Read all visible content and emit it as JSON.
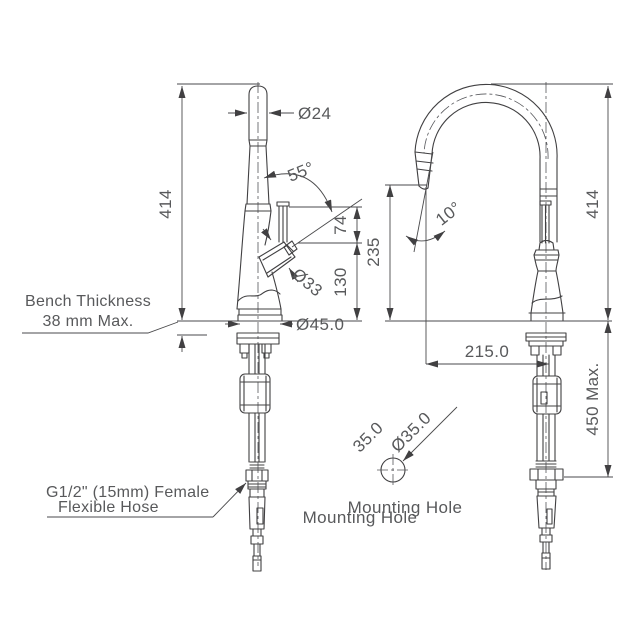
{
  "drawing": {
    "side_view": {
      "spout_diameter": "Ø24",
      "handle_angle": "55°",
      "height_above_bench": "414",
      "lever_length": "74",
      "handle_height": "130",
      "handle_diameter": "Ø33",
      "base_diameter": "Ø45.0",
      "bench_note": {
        "line1": "Bench Thickness",
        "line2": "38 mm Max."
      },
      "hose_note": {
        "line1": "G1/2\" (15mm) Female",
        "line2": "Flexible Hose"
      }
    },
    "front_view": {
      "height_above_bench": "414",
      "outlet_height": "235",
      "spray_angle": "10°",
      "spout_reach": "215.0",
      "under_bench_depth": "450 Max.",
      "mounting_dia_label_a": "35.0",
      "mounting_dia_label_b": "Ø35.0",
      "mounting_caption_a": "Mounting Hole",
      "mounting_caption_b": "Mounting Hole"
    },
    "colors": {
      "line": "#414042",
      "text": "#58595b",
      "background": "#ffffff"
    }
  }
}
